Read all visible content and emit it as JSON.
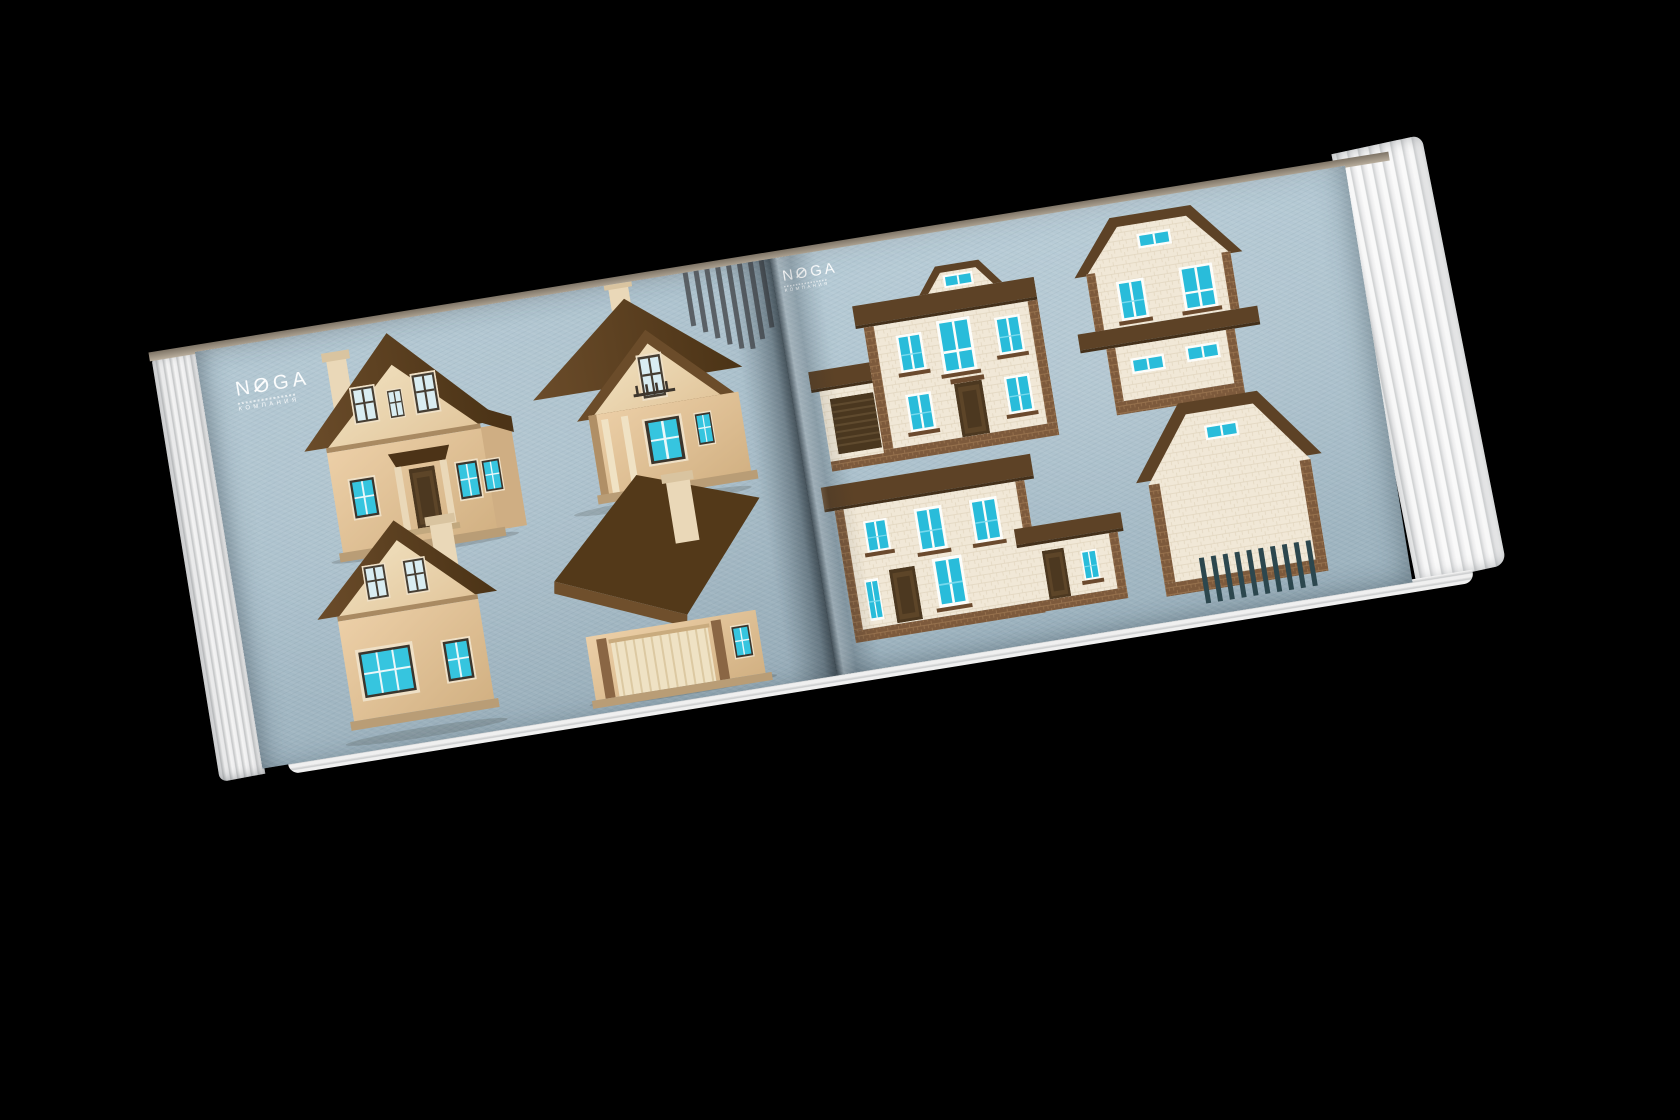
{
  "scene": {
    "background_color": "#000000",
    "subject": "Open architecture catalog mockup with house renderings on blue-gray paper"
  },
  "brand": {
    "name": "NOGA",
    "subtitle": "КОМПАНИЯ"
  },
  "palette": {
    "page_paper": "#a9bfcb",
    "roof_brown": "#5d4226",
    "wall_cream": "#f1e8d7",
    "wall_tan": "#e0c49c",
    "window_glass_cyan": "#29bcda",
    "window_glass_pale": "#d9edf2",
    "brick_trim": "#7d5a3c",
    "paper_edge": "#eeeeee",
    "stripe_top_color": "#51555a",
    "stripe_bottom_color": "#2c474e"
  },
  "left_page": {
    "houses": [
      {
        "id": "house-1",
        "style": "3d-render",
        "view": "two-story gable house, front elevation with porch, chimney and side wing"
      },
      {
        "id": "house-2",
        "style": "3d-render",
        "view": "two-story house with balcony gable and deep overhanging roof"
      },
      {
        "id": "house-3",
        "style": "3d-render",
        "view": "one-and-a-half story gable house with large picture window and chimney"
      },
      {
        "id": "house-4",
        "style": "3d-render",
        "view": "sweeping roof slab with chimney over garage front"
      }
    ]
  },
  "right_page": {
    "houses": [
      {
        "id": "house-5",
        "style": "flat-elevation",
        "view": "two-story facade with center dormer, entry door and attached garage with roller door"
      },
      {
        "id": "house-6",
        "style": "flat-elevation",
        "view": "two-story facade with gambrel top, intermediate pent roof and paired windows"
      },
      {
        "id": "house-7",
        "style": "flat-elevation",
        "view": "two-story facade with single-story wing, two doors and windows"
      },
      {
        "id": "house-8",
        "style": "flat-elevation",
        "view": "gable-end elevation with small attic window and brick quoins"
      }
    ]
  },
  "decor": [
    {
      "target": "stripes-top-left-page",
      "count": 8,
      "heights": [
        56,
        64,
        72,
        80,
        86,
        88,
        80,
        70
      ],
      "width": 5,
      "gap": 6,
      "color": "#51555a"
    },
    {
      "target": "stripes-bottom-right-page",
      "count": 10,
      "heights": [
        46,
        46,
        46,
        46,
        46,
        46,
        46,
        46,
        46,
        46
      ],
      "width": 5,
      "gap": 7,
      "color": "#2c474e"
    }
  ]
}
